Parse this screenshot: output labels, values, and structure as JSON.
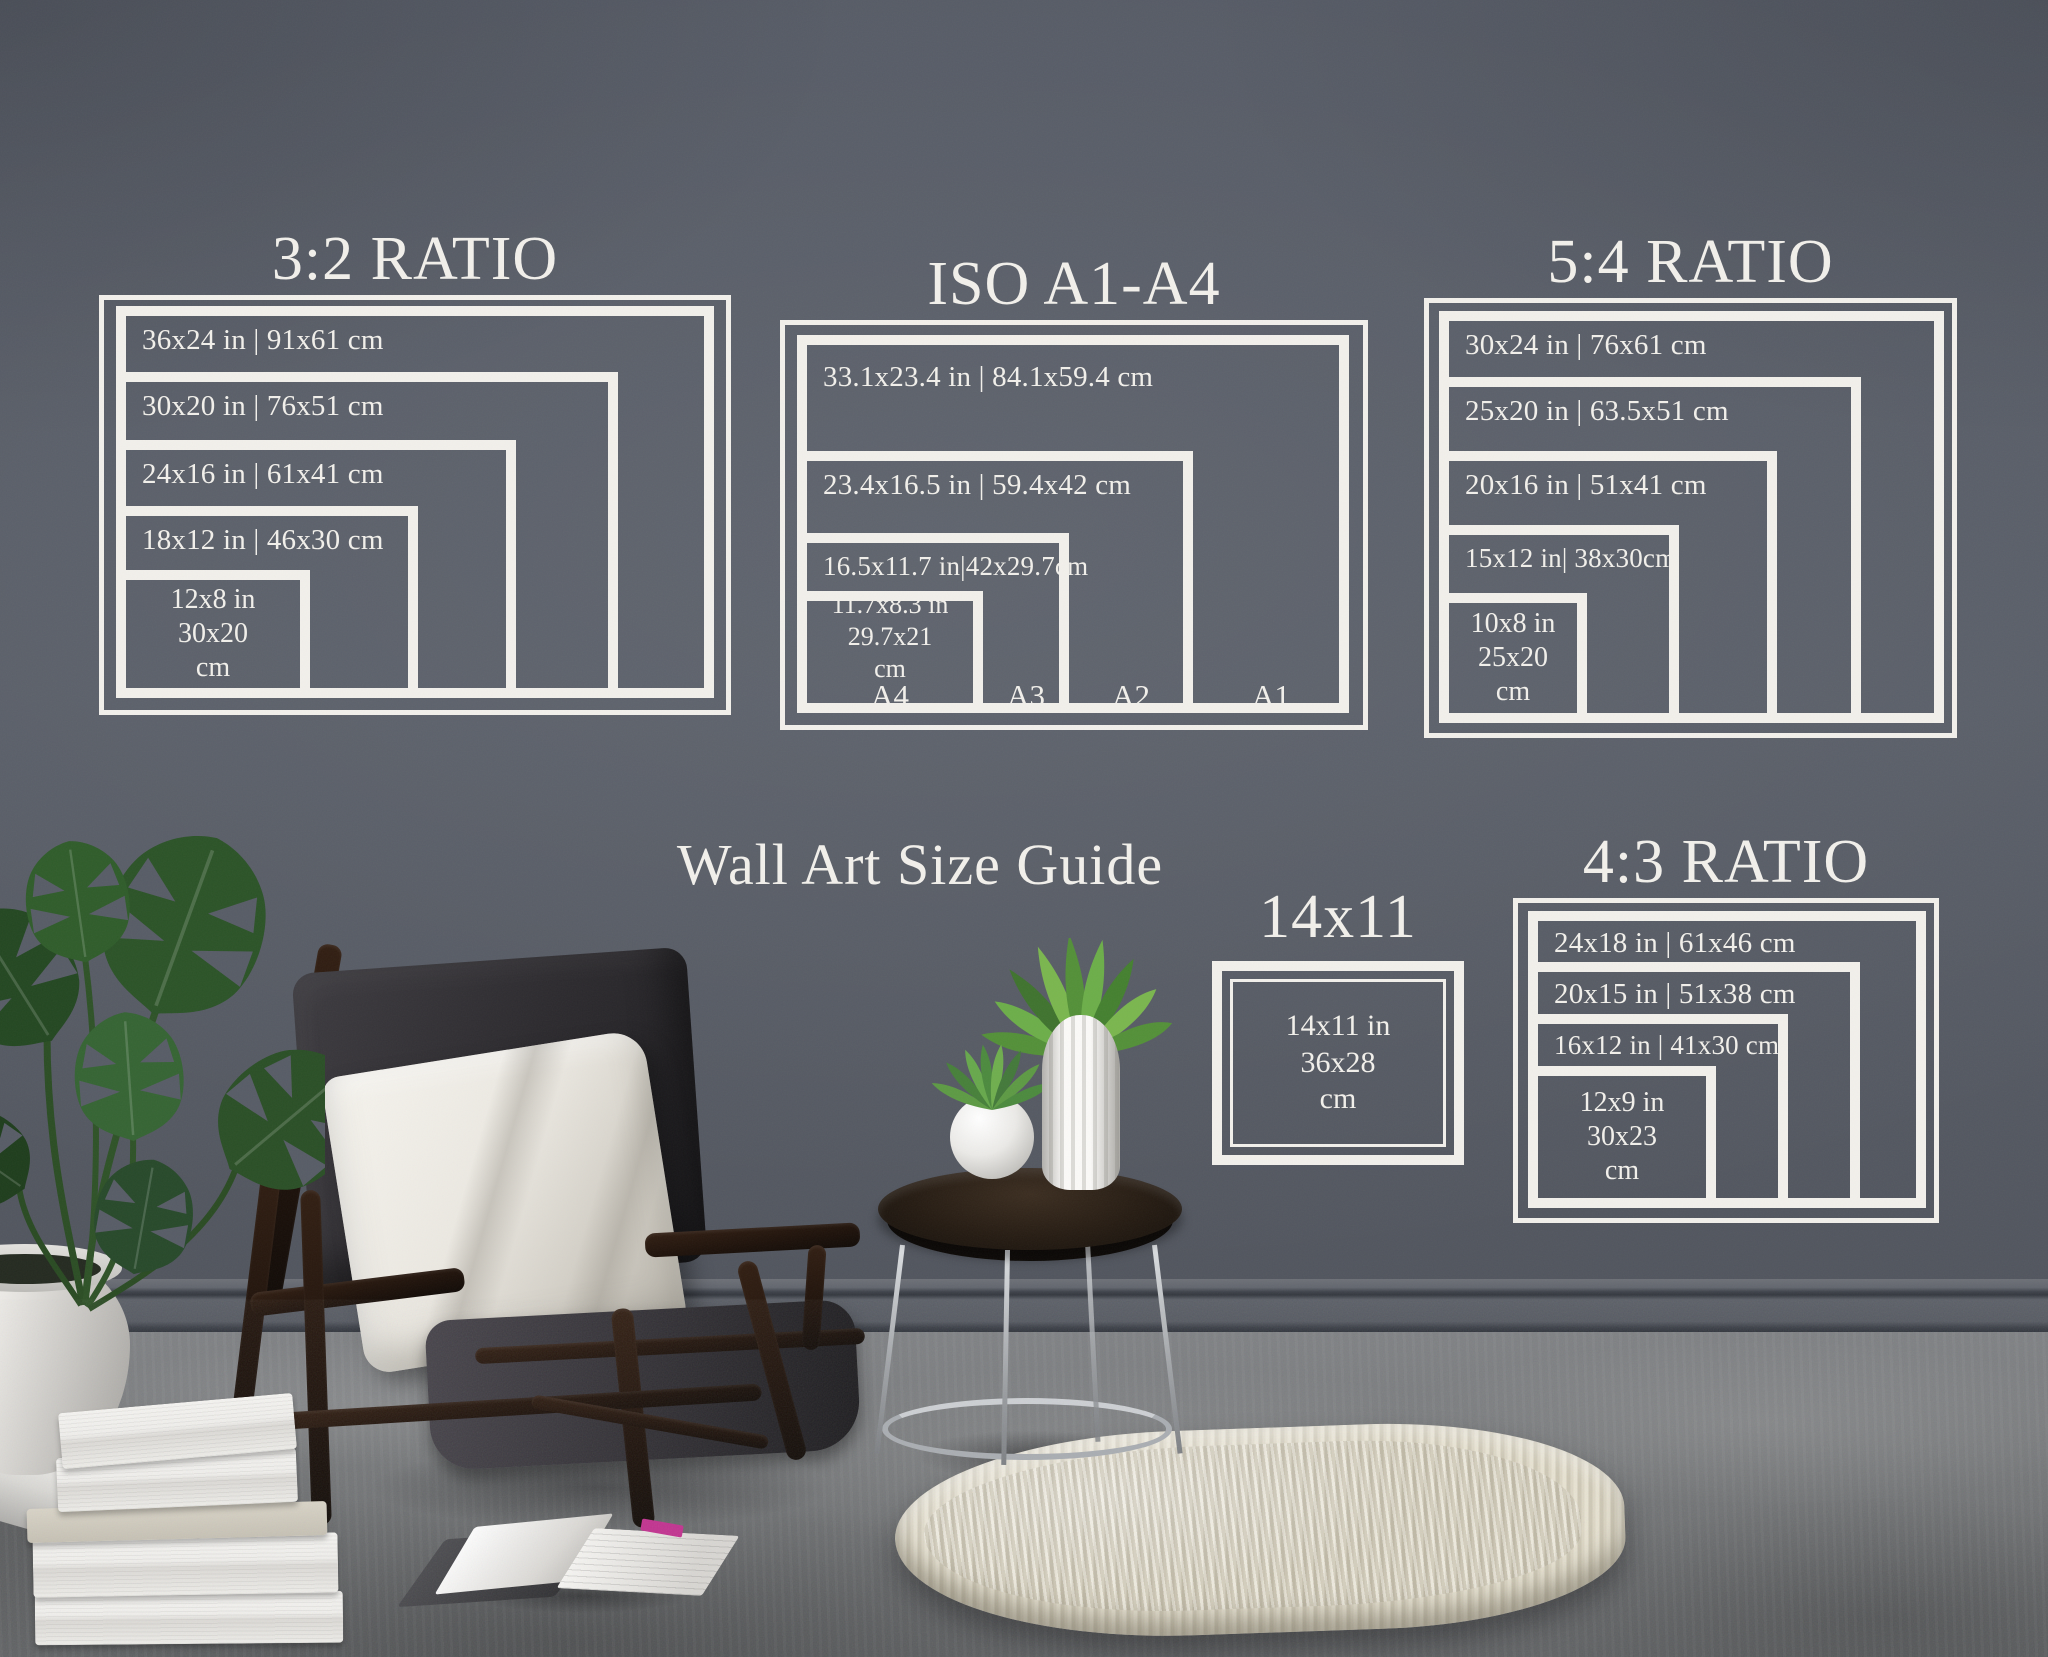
{
  "wall_title": "Wall Art Size Guide",
  "blocks": {
    "ratio_3_2": {
      "title": "3:2 RATIO",
      "sizes": [
        "36x24 in | 91x61 cm",
        "30x20 in | 76x51 cm",
        "24x16 in | 61x41 cm",
        "18x12 in | 46x30 cm"
      ],
      "smallest": [
        "12x8 in",
        "30x20",
        "cm"
      ]
    },
    "iso_a1_a4": {
      "title": "ISO A1-A4",
      "sizes": [
        "33.1x23.4 in | 84.1x59.4 cm",
        "23.4x16.5 in | 59.4x42 cm",
        "16.5x11.7 in|42x29.7cm"
      ],
      "smallest": [
        "11.7x8.3 in",
        "29.7x21",
        "cm"
      ],
      "paper_labels": [
        "A4",
        "A3",
        "A2",
        "A1"
      ]
    },
    "ratio_5_4": {
      "title": "5:4 RATIO",
      "sizes": [
        "30x24 in | 76x61 cm",
        "25x20 in | 63.5x51 cm",
        "20x16 in | 51x41 cm",
        "15x12 in| 38x30cm"
      ],
      "smallest": [
        "10x8 in",
        "25x20",
        "cm"
      ]
    },
    "ratio_4_3": {
      "title": "4:3 RATIO",
      "sizes": [
        "24x18 in | 61x46 cm",
        "20x15 in | 51x38 cm",
        "16x12 in | 41x30 cm"
      ],
      "smallest": [
        "12x9 in",
        "30x23",
        "cm"
      ]
    },
    "frame_14x11": {
      "title": "14x11",
      "smallest": [
        "14x11 in",
        "36x28",
        "cm"
      ]
    }
  },
  "colors": {
    "frame_lines": "#f2f0eb",
    "wall": "#575c66",
    "baseboard": "#555961",
    "floor": "#76787a",
    "leaf_green": "#2f5a2c",
    "wood_dark": "#241a14",
    "chrome": "#b7babe",
    "pillow": "#ece9e3",
    "cushion": "#2c2a2e",
    "rug": "#dcd7c5",
    "book_white": "#f1f0ed",
    "bookmark_pink": "#c2308f"
  }
}
